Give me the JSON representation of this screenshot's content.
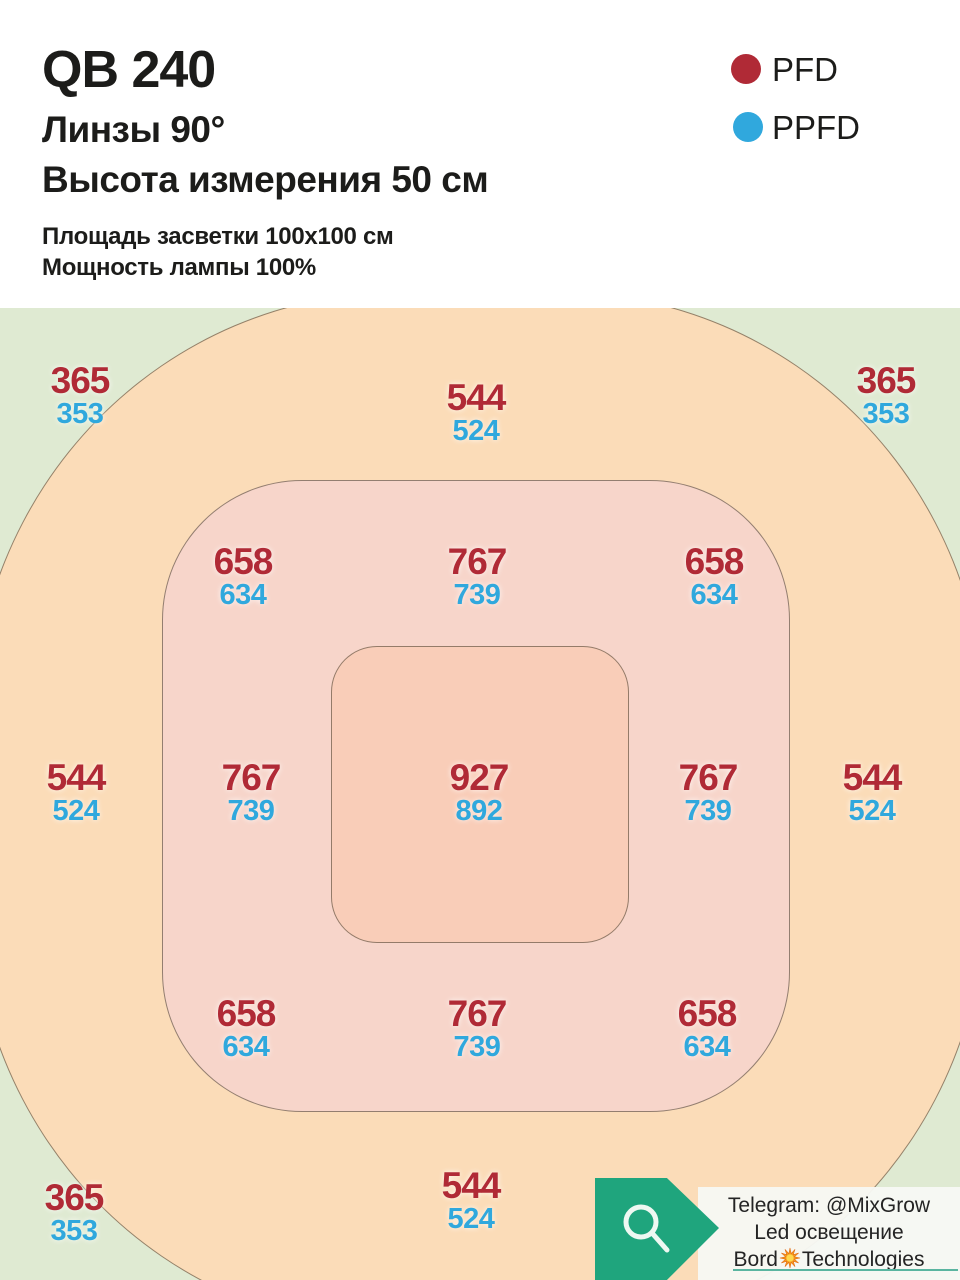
{
  "header": {
    "title": "QB 240",
    "lens_line": "Линзы 90°",
    "height_line": "Высота измерения 50 см",
    "area_line": "Площадь засветки 100x100 см",
    "power_line": "Мощность лампы 100%"
  },
  "legend": {
    "pfd_label": "PFD",
    "ppfd_label": "PPFD",
    "pfd_color": "#b02a36",
    "ppfd_color": "#30a8dd"
  },
  "map": {
    "zones": {
      "background_color": "#dfead2",
      "outer_color": "#fbdcb8",
      "middle_color": "#f7d5ca",
      "inner_color": "#f9cdb8"
    },
    "cells": {
      "top_left": {
        "pfd": "365",
        "ppfd": "353"
      },
      "top_center": {
        "pfd": "544",
        "ppfd": "524"
      },
      "top_right": {
        "pfd": "365",
        "ppfd": "353"
      },
      "ring_top_left": {
        "pfd": "658",
        "ppfd": "634"
      },
      "ring_top_center": {
        "pfd": "767",
        "ppfd": "739"
      },
      "ring_top_right": {
        "pfd": "658",
        "ppfd": "634"
      },
      "mid_far_left": {
        "pfd": "544",
        "ppfd": "524"
      },
      "mid_left": {
        "pfd": "767",
        "ppfd": "739"
      },
      "center": {
        "pfd": "927",
        "ppfd": "892"
      },
      "mid_right": {
        "pfd": "767",
        "ppfd": "739"
      },
      "mid_far_right": {
        "pfd": "544",
        "ppfd": "524"
      },
      "ring_bottom_left": {
        "pfd": "658",
        "ppfd": "634"
      },
      "ring_bottom_center": {
        "pfd": "767",
        "ppfd": "739"
      },
      "ring_bottom_right": {
        "pfd": "658",
        "ppfd": "634"
      },
      "bottom_left": {
        "pfd": "365",
        "ppfd": "353"
      },
      "bottom_center": {
        "pfd": "544",
        "ppfd": "524"
      }
    }
  },
  "badge": {
    "telegram_line": "Telegram: @MixGrow",
    "middle_line": "Led освещение",
    "brand_prefix": "Bord",
    "brand_suffix": "Technologies",
    "tag_color": "#1fa57d",
    "underline_color": "#5ab5a0"
  },
  "chart_data": {
    "type": "heatmap",
    "title": "QB 240 — Линзы 90°, Высота измерения 50 см, Площадь засветки 100x100 см, Мощность лампы 100%",
    "legend_entries": [
      "PFD",
      "PPFD"
    ],
    "layout_hint": "concentric rounded zones over 100x100 cm area; values at grid points; bottom-right corner value hidden by watermark badge",
    "series": [
      {
        "name": "PFD",
        "grid": [
          [
            365,
            null,
            544,
            null,
            365
          ],
          [
            null,
            658,
            767,
            658,
            null
          ],
          [
            544,
            767,
            927,
            767,
            544
          ],
          [
            null,
            658,
            767,
            658,
            null
          ],
          [
            365,
            null,
            544,
            null,
            null
          ]
        ]
      },
      {
        "name": "PPFD",
        "grid": [
          [
            353,
            null,
            524,
            null,
            353
          ],
          [
            null,
            634,
            739,
            634,
            null
          ],
          [
            524,
            739,
            892,
            739,
            524
          ],
          [
            null,
            634,
            739,
            634,
            null
          ],
          [
            353,
            null,
            524,
            null,
            null
          ]
        ]
      }
    ]
  }
}
